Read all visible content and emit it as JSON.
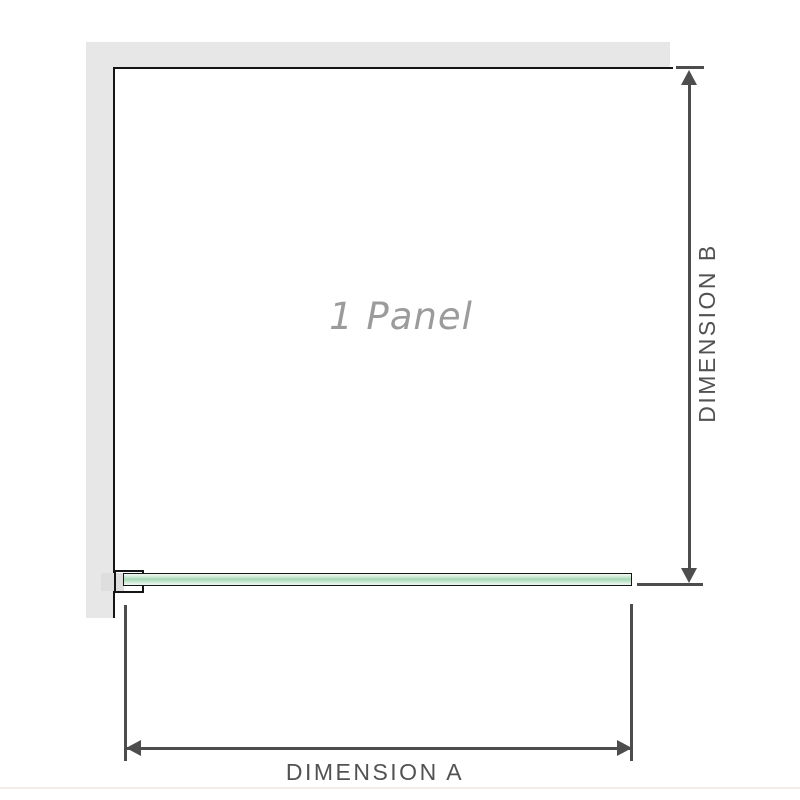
{
  "labels": {
    "panel": "1 Panel",
    "dimension_a": "DIMENSION A",
    "dimension_b": "DIMENSION B"
  },
  "colors": {
    "wall": "#e7e7e7",
    "outline": "#151515",
    "dimension_line": "#4d4d4d",
    "dimension_text": "#525252",
    "panel_text": "#9b9b9b",
    "glass_light": "#d9efdf",
    "glass_mid": "#a6d8b5",
    "clamp_insert": "#dedede",
    "background": "#ffffff"
  }
}
